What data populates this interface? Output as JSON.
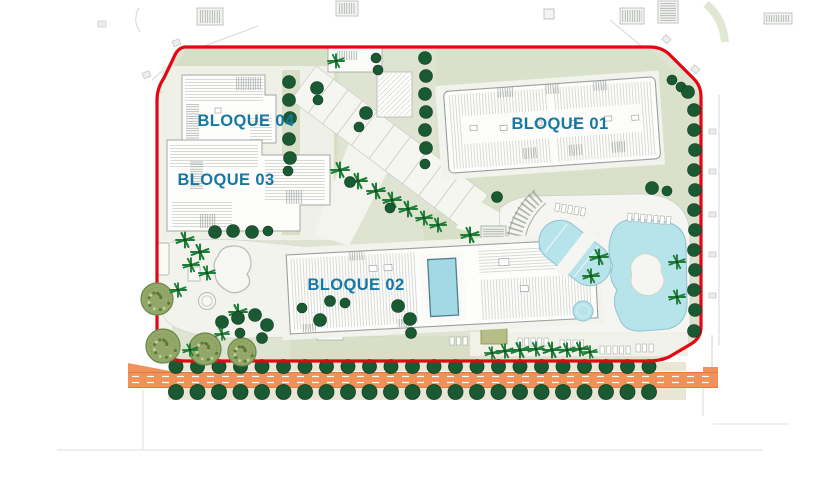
{
  "plan": {
    "labels": {
      "bloque01": "BLOQUE 01",
      "bloque02": "BLOQUE 02",
      "bloque03": "BLOQUE 03",
      "bloque04": "BLOQUE 04"
    },
    "colors": {
      "boundary_red": "#e30613",
      "label_blue": "#1578a2",
      "pool_cyan": "#b7e3ea",
      "rooftop_pool_cyan": "#a3d8e5",
      "road_orange": "#f0915a",
      "site_sage": "#dfe4d2",
      "lawn_green": "#d7dfc6",
      "paved_light": "#f1f3ec",
      "tree_dark_green": "#1a5a32",
      "palm_green": "#1e7d36",
      "canopy_olive": "#93a868",
      "sidewalk_beige": "#e9e6d5"
    }
  }
}
